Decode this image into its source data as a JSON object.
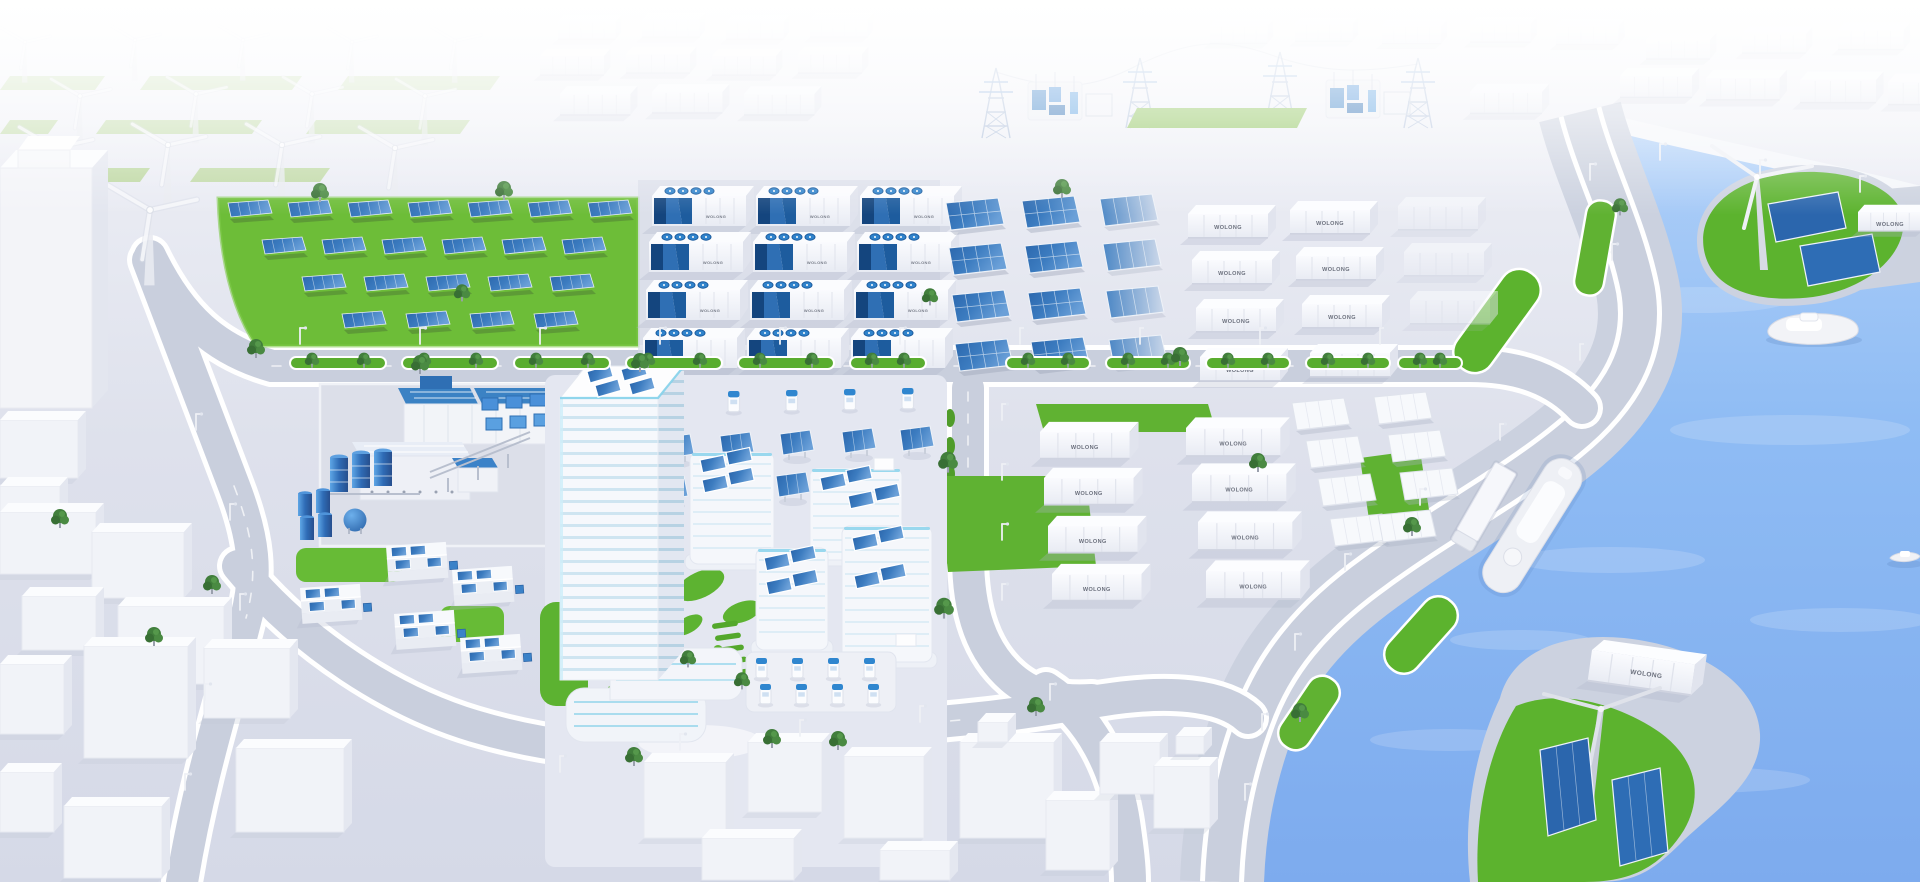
{
  "scene": {
    "alt": "Aerial 3D illustration of a WOLONG zero-carbon smart energy industrial park beside a river: wind farm, solar farm, battery energy storage containers, transmission pylons and substations, a green office campus with rooftop solar, factories with solar roofs, EV chargers, a waterfront promenade, green islands with wind turbines and solar panels, and boats on the blue water."
  },
  "brand": {
    "label": "WOLONG"
  },
  "colors": {
    "sky_top": "#ffffff",
    "ground": "#dde1ec",
    "road": "#c9cfdd",
    "curb": "#ffffff",
    "grass": "#64b735",
    "grass_light": "#a9cf7d",
    "water": "#84b6f2",
    "water_light": "#aecff8",
    "panel_blue": "#2f6fb4",
    "panel_blue_light": "#6ba0d8",
    "accent_cyan": "#3fc0e8",
    "container_white": "#f2f3f7",
    "container_shade": "#dfe2ec",
    "equipment_blue": "#3b82c8",
    "tree_green": "#3e7d46",
    "label_grey": "#6a6f7c"
  },
  "counts": {
    "wind_turbines_onshore": 15,
    "wind_turbines_island": 2,
    "solar_farm_arrays": 22,
    "ground_solar_arrays": 12,
    "blank_solar_arrays": 8,
    "battery_storage_units": 12,
    "labeled_containers": 18,
    "faded_containers": 24,
    "transmission_pylons": 4,
    "substations": 2,
    "ev_chargers": 13,
    "solar_carports": 8,
    "factory_buildings": 5,
    "storage_tanks": 3,
    "boats": 4,
    "islands": 2
  }
}
